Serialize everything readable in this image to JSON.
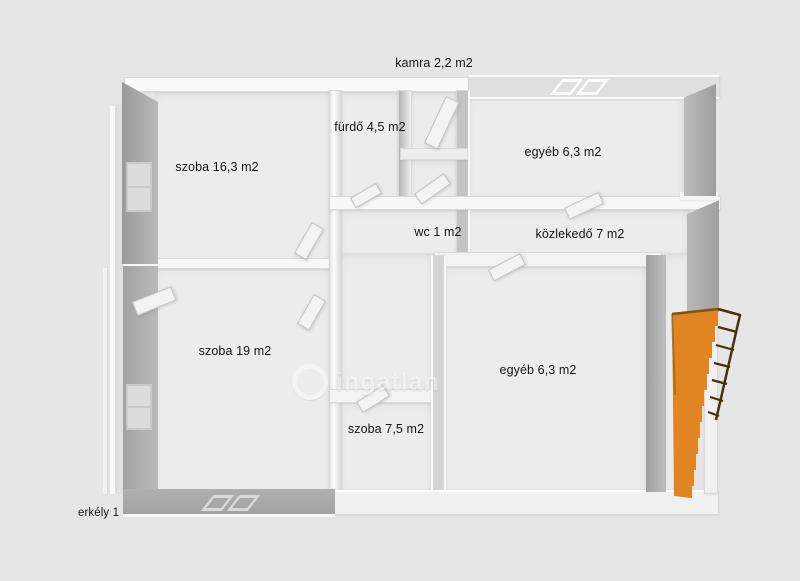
{
  "canvas": {
    "background": "#e6e6e6",
    "plan_floor": "#ececec"
  },
  "colors": {
    "wall_gray": "#a8a8a8",
    "wall_white": "#f7f7f7",
    "stairs_orange": "#e08522",
    "stairs_edge": "#7a560f",
    "ladder_brown": "#46320a",
    "label_text": "#151515"
  },
  "rooms": {
    "kamra": "kamra 2,2 m2",
    "szoba16": "szoba 16,3 m2",
    "furdo": "fürdő 4,5 m2",
    "egyebTop": "egyéb 6,3 m2",
    "wc": "wc 1 m2",
    "kozlekedo": "közlekedő 7 m2",
    "szoba19": "szoba 19 m2",
    "egyebMid": "egyéb 6,3 m2",
    "szoba75": "szoba 7,5 m2",
    "erkely": "erkély 1"
  },
  "watermark": {
    "text": "ingatlan"
  }
}
